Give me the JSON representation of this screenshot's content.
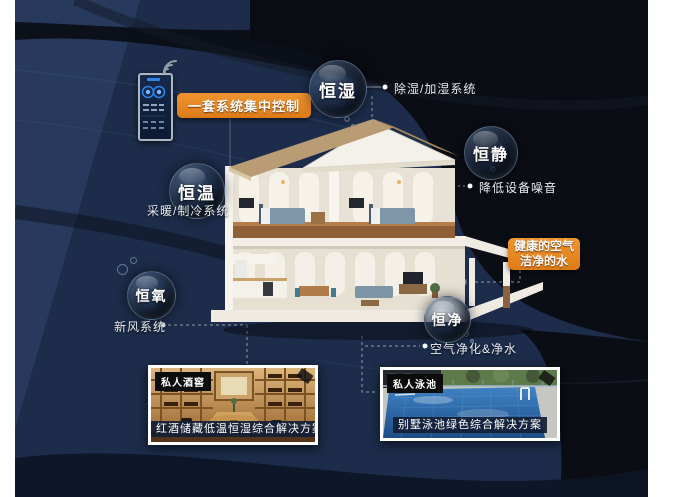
{
  "poster": {
    "background_color": "#1c2c4a",
    "accent_color": "#e2801f"
  },
  "controller": {
    "device": "smart-control-panel",
    "callout": "一套系统集中控制"
  },
  "bubbles": [
    {
      "label": "恒湿",
      "note": "除湿/加湿系统"
    },
    {
      "label": "恒静",
      "note": "降低设备噪音"
    },
    {
      "label": "恒温",
      "note": "采暖/制冷系统"
    },
    {
      "label": "恒氧",
      "note": "新风系统"
    },
    {
      "label": "恒净",
      "note": "空气净化&净水"
    }
  ],
  "highlight": {
    "line1": "健康的空气",
    "line2": "洁净的水"
  },
  "cards": [
    {
      "badge": "私人酒窖",
      "caption": "红酒储藏低温恒湿综合解决方案"
    },
    {
      "badge": "私人泳池",
      "caption": "别墅泳池绿色综合解决方案"
    }
  ]
}
